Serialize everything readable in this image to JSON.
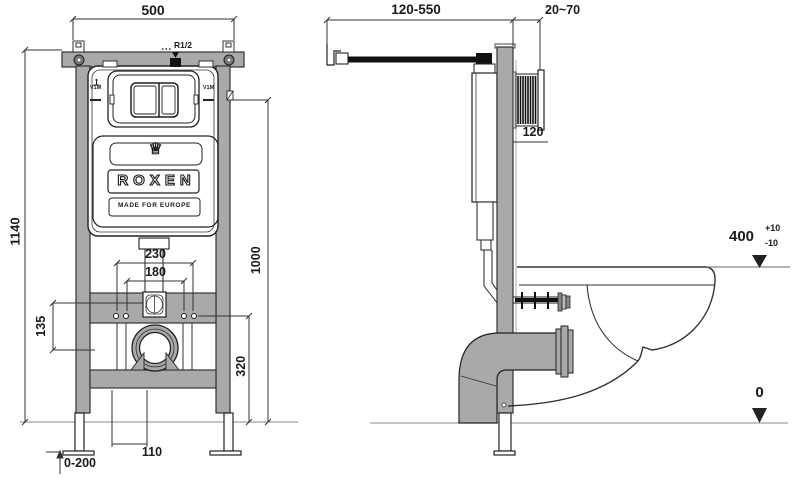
{
  "front_view": {
    "dims": {
      "width": "500",
      "height": "1140",
      "inlet_thread": "R1/2",
      "bolt_spacing_outer": "230",
      "bolt_spacing_inner": "180",
      "inlet_drain_offset": "135",
      "panel_level": "1000",
      "drain_level": "320",
      "outlet_width": "110",
      "leg_adjust_range": "0-200"
    },
    "plate": {
      "valve_left": "V1M",
      "valve_right": "V1M"
    },
    "brand": {
      "name": "ROXEN",
      "tagline": "MADE FOR EUROPE"
    }
  },
  "side_view": {
    "dims": {
      "rod_range": "120-550",
      "wall_finish_range": "20~70",
      "frame_depth": "120",
      "rim_height": "400",
      "rim_tol_plus": "+10",
      "rim_tol_minus": "-10",
      "floor_level": "0"
    }
  },
  "icons": {
    "crown": "♕"
  },
  "colors": {
    "frame_gray": "#a9a9a9",
    "line": "#333333",
    "background": "#ffffff"
  }
}
